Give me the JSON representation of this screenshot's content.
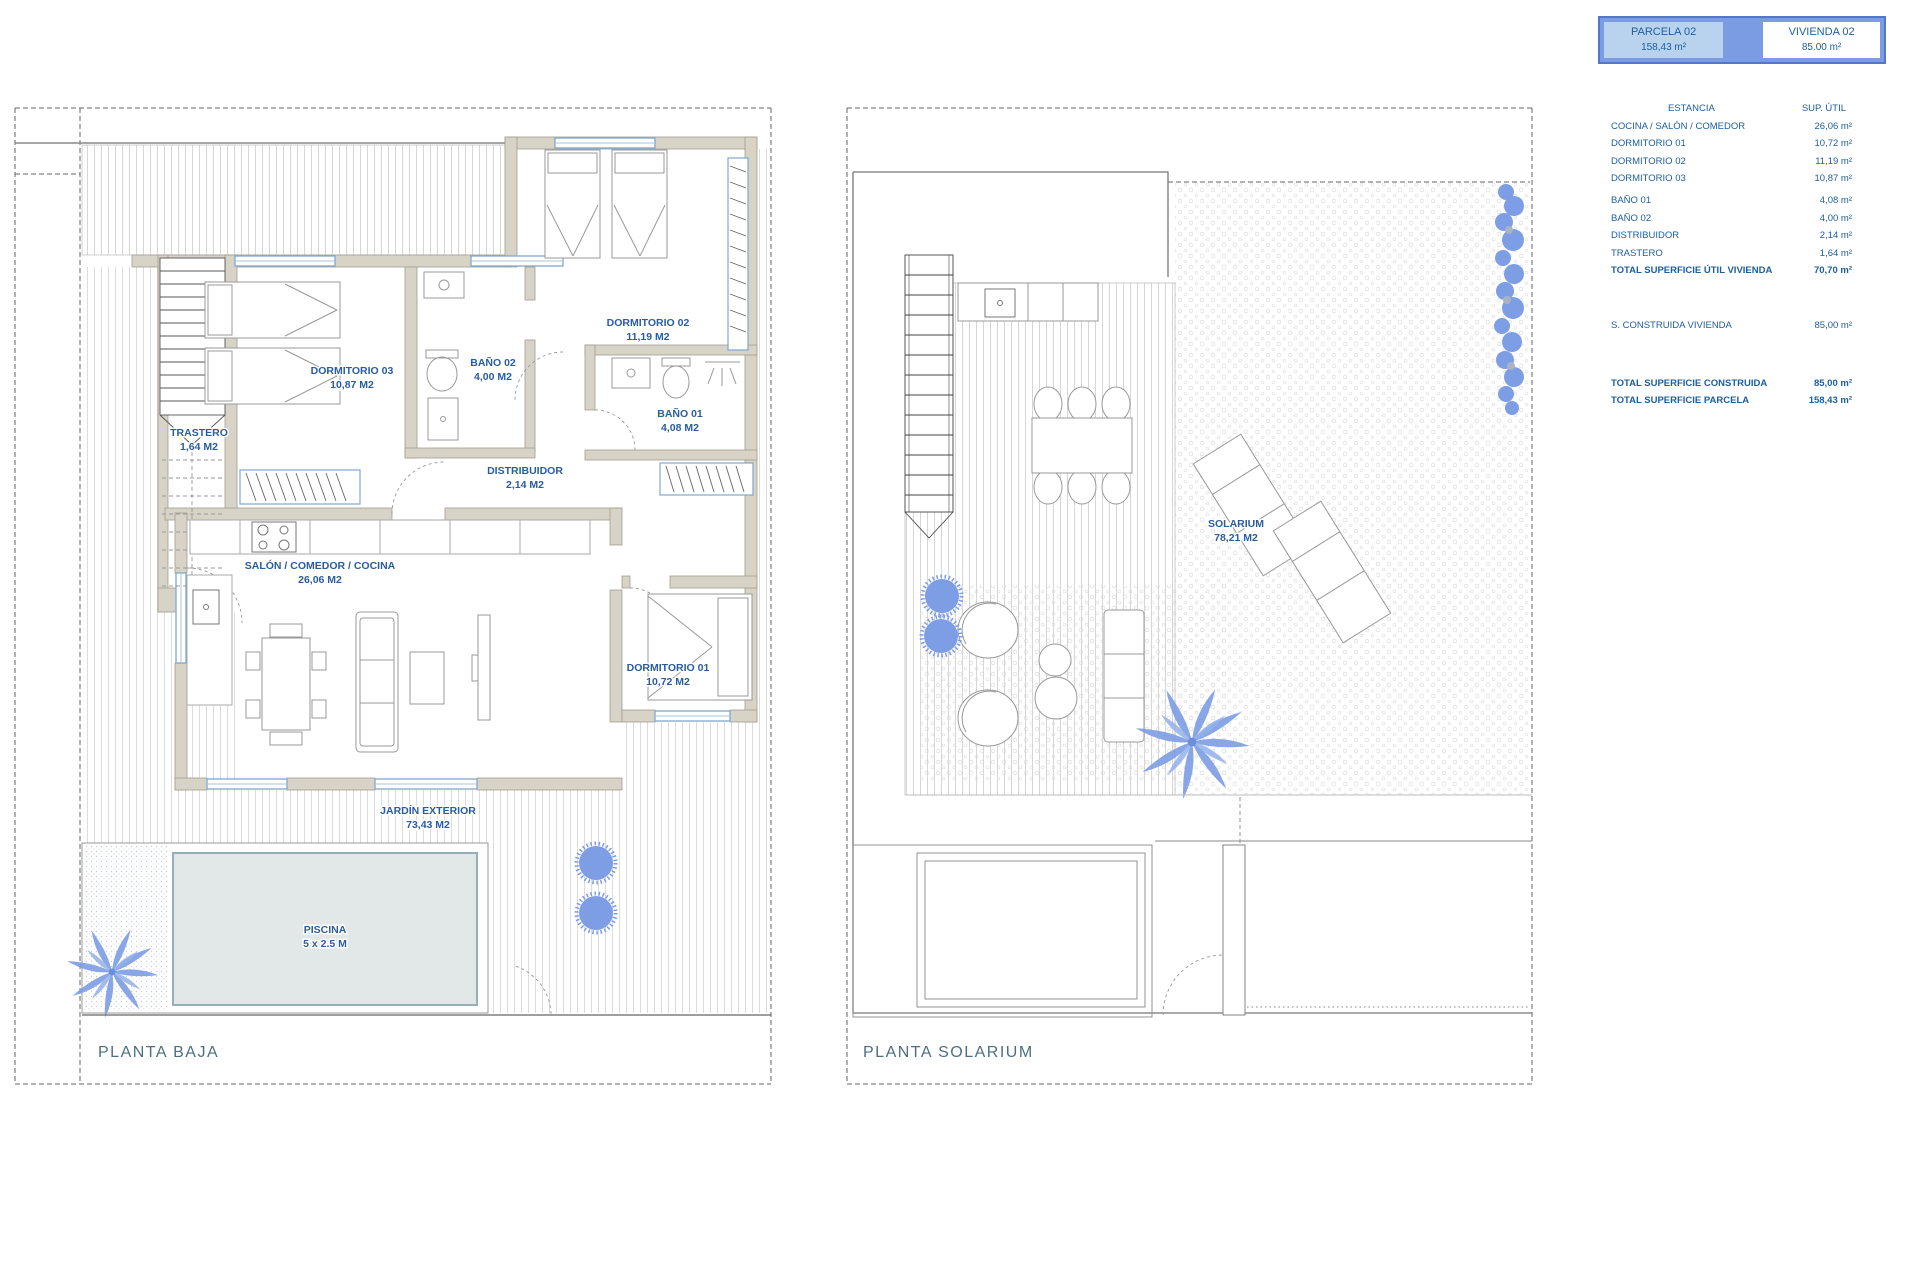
{
  "summary": {
    "parcela": {
      "label": "PARCELA 02",
      "area": "158,43 m²"
    },
    "vivienda": {
      "label": "VIVIENDA 02",
      "area": "85.00 m²"
    },
    "columns": {
      "estancia": "ESTANCIA",
      "sup_util": "SUP. ÚTIL"
    },
    "rows": [
      {
        "label": "COCINA / SALÓN / COMEDOR",
        "value": "26,06 m²"
      },
      {
        "label": "DORMITORIO 01",
        "value": "10,72 m²"
      },
      {
        "label": "DORMITORIO 02",
        "value": "11,19 m²"
      },
      {
        "label": "DORMITORIO 03",
        "value": "10,87 m²"
      },
      {
        "label": "BAÑO 01",
        "value": "4,08 m²"
      },
      {
        "label": "BAÑO 02",
        "value": "4,00 m²"
      },
      {
        "label": "DISTRIBUIDOR",
        "value": "2,14 m²"
      },
      {
        "label": "TRASTERO",
        "value": "1,64 m²"
      }
    ],
    "total_util": {
      "label": "TOTAL SUPERFICIE ÚTIL VIVIENDA",
      "value": "70,70 m²"
    },
    "construida": {
      "label": "S. CONSTRUIDA VIVIENDA",
      "value": "85,00 m²"
    },
    "total_construida": {
      "label": "TOTAL SUPERFICIE CONSTRUIDA",
      "value": "85,00 m²"
    },
    "total_parcela": {
      "label": "TOTAL SUPERFICIE PARCELA",
      "value": "158,43 m²"
    }
  },
  "plans": {
    "baja": {
      "title": "PLANTA BAJA",
      "labels": {
        "trastero": {
          "name": "TRASTERO",
          "area": "1,64 M2"
        },
        "dormitorio03": {
          "name": "DORMITORIO 03",
          "area": "10,87 M2"
        },
        "bano02": {
          "name": "BAÑO 02",
          "area": "4,00 M2"
        },
        "dormitorio02": {
          "name": "DORMITORIO 02",
          "area": "11,19 M2"
        },
        "bano01": {
          "name": "BAÑO 01",
          "area": "4,08 M2"
        },
        "distribuidor": {
          "name": "DISTRIBUIDOR",
          "area": "2,14 M2"
        },
        "salon": {
          "name": "SALÓN / COMEDOR / COCINA",
          "area": "26,06 M2"
        },
        "dormitorio01": {
          "name": "DORMITORIO 01",
          "area": "10,72 M2"
        },
        "jardin": {
          "name": "JARDÍN EXTERIOR",
          "area": "73,43 M2"
        },
        "piscina": {
          "name": "PISCINA",
          "area": "5 x 2.5 M"
        }
      }
    },
    "solarium": {
      "title": "PLANTA SOLARIUM",
      "labels": {
        "solarium": {
          "name": "SOLARIUM",
          "area": "78,21 M2"
        }
      }
    }
  },
  "colors": {
    "wall_fill": "#d7d3c6",
    "label_blue": "#2a5d9f",
    "title_teal": "#4c7082",
    "vegetation_blue": "#7d9de5",
    "pool_water": "#e1e8e7",
    "header_frame_blue": "#7b9ce3",
    "header_parcela_fill": "#b9d3ef"
  }
}
